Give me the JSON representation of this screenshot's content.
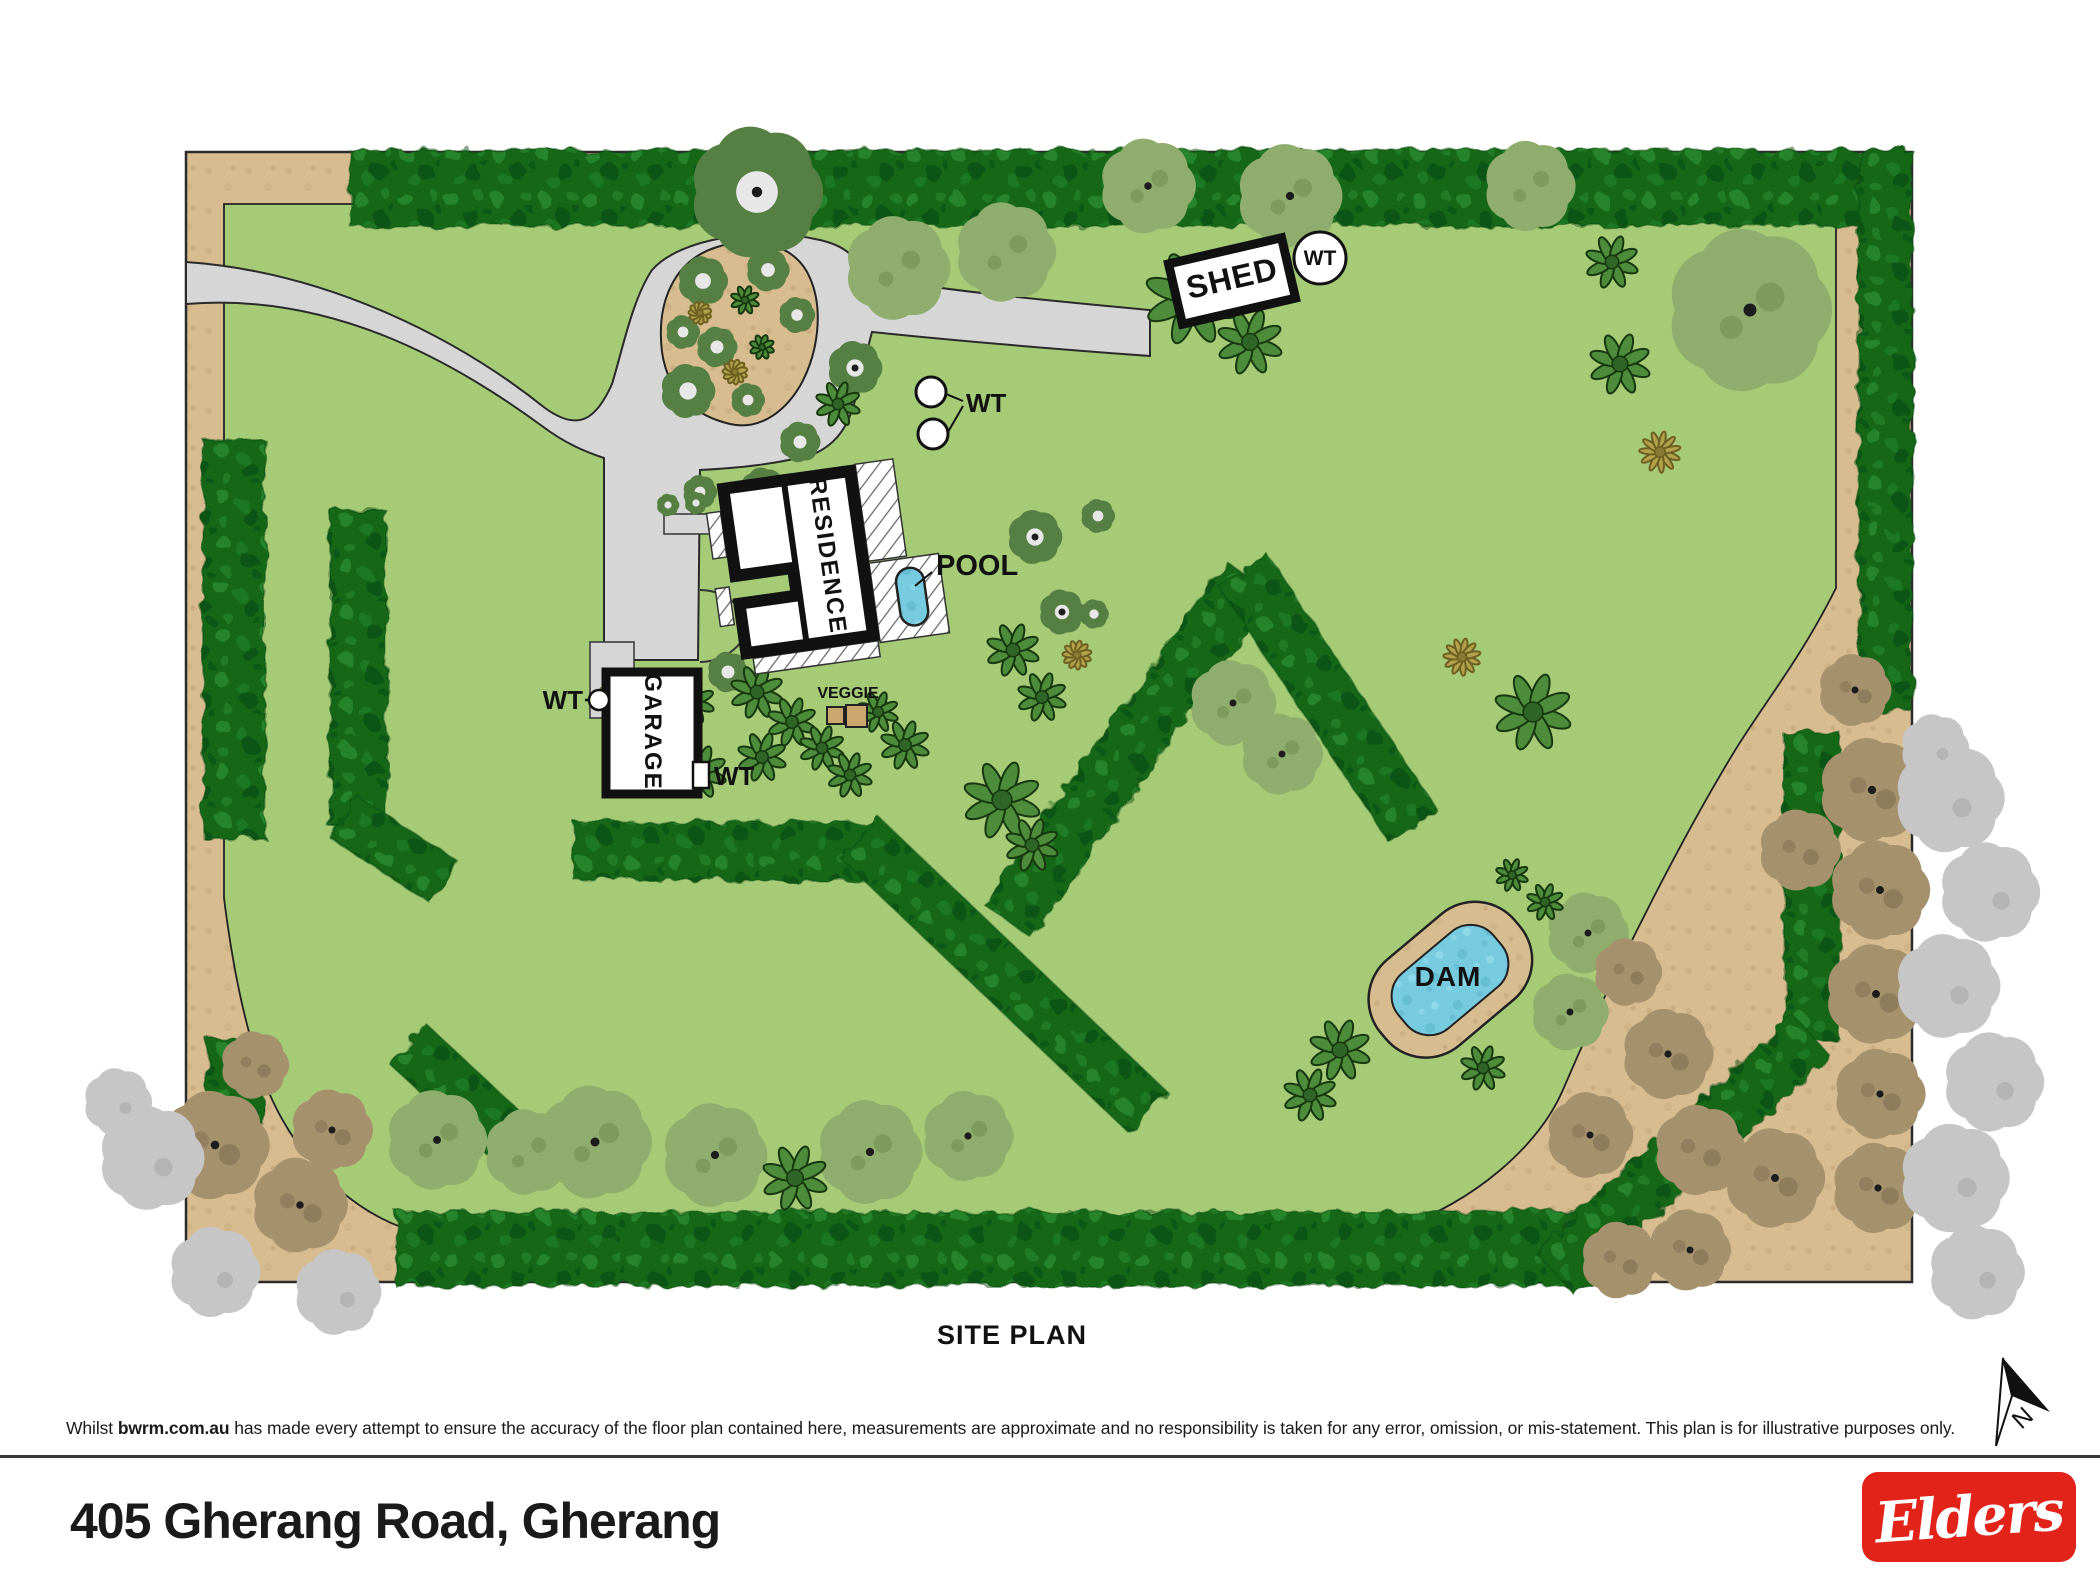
{
  "meta": {
    "address": "405 Gherang Road, Gherang",
    "plan_title": "SITE PLAN"
  },
  "labels": {
    "shed": "SHED",
    "residence": "RESIDENCE",
    "garage": "GARAGE",
    "pool": "POOL",
    "veggie": "VEGGIE",
    "dam": "DAM",
    "wt": "WT",
    "north": "N"
  },
  "disclaimer": {
    "prefix": "Whilst ",
    "brand": "bwrm.com.au",
    "suffix": " has made every attempt to ensure the accuracy of the floor plan contained here, measurements are approximate and no responsibility is taken for any error, omission, or mis-statement. This plan is for illustrative purposes only."
  },
  "logo": {
    "text": "Elders",
    "color": "#e2231a"
  },
  "colors": {
    "grass": "#a5cb76",
    "border_tan": "#d7bc90",
    "hedge": "#156818",
    "hedge_light": "#2e9032",
    "road": "#d6d6d6",
    "water": "#76cbdf",
    "building": "#111111",
    "olive_tree": "#8fae6d",
    "dark_tree": "#567f43",
    "star_bush": "#4d8c3a",
    "yellow_bush": "#b3a14c",
    "scrub_tree": "#a6916d",
    "gray_tree": "#c6c6c6",
    "logo_red": "#e2231a"
  },
  "plan": {
    "hedges": [
      {
        "x": 350,
        "y": 188,
        "len": 1560,
        "w": 76,
        "a": 0
      },
      {
        "x": 1885,
        "y": 150,
        "len": 560,
        "w": 54,
        "a": 90
      },
      {
        "x": 396,
        "y": 1249,
        "len": 1244,
        "w": 74,
        "a": 0
      },
      {
        "x": 234,
        "y": 440,
        "len": 398,
        "w": 62,
        "a": 90
      },
      {
        "x": 236,
        "y": 1040,
        "len": 86,
        "w": 58,
        "a": 90
      },
      {
        "x": 358,
        "y": 510,
        "len": 318,
        "w": 56,
        "a": 90
      },
      {
        "x": 345,
        "y": 818,
        "len": 118,
        "w": 50,
        "a": 33
      },
      {
        "x": 408,
        "y": 1044,
        "len": 160,
        "w": 54,
        "a": 43
      },
      {
        "x": 574,
        "y": 851,
        "len": 304,
        "w": 58,
        "a": 0
      },
      {
        "x": 860,
        "y": 838,
        "len": 398,
        "w": 56,
        "a": 43.6
      },
      {
        "x": 1250,
        "y": 578,
        "len": 420,
        "w": 58,
        "a": 125.3
      },
      {
        "x": 1243,
        "y": 570,
        "len": 308,
        "w": 58,
        "a": 56.4
      },
      {
        "x": 1812,
        "y": 733,
        "len": 306,
        "w": 56,
        "a": 90
      },
      {
        "x": 1812,
        "y": 1036,
        "len": 350,
        "w": 56,
        "a": 137.6
      }
    ],
    "trees": [
      {
        "t": "o",
        "x": 898,
        "y": 268,
        "r": 46
      },
      {
        "t": "o",
        "x": 1006,
        "y": 252,
        "r": 44
      },
      {
        "t": "o",
        "x": 1148,
        "y": 186,
        "r": 42,
        "d": 1
      },
      {
        "t": "o",
        "x": 1290,
        "y": 196,
        "r": 46,
        "d": 1
      },
      {
        "t": "o",
        "x": 1530,
        "y": 186,
        "r": 40
      },
      {
        "t": "o",
        "x": 1750,
        "y": 310,
        "r": 72,
        "d": 1
      },
      {
        "t": "o",
        "x": 1233,
        "y": 703,
        "r": 38,
        "d": 1
      },
      {
        "t": "o",
        "x": 1282,
        "y": 754,
        "r": 36,
        "d": 1
      },
      {
        "t": "o",
        "x": 1588,
        "y": 933,
        "r": 36,
        "d": 1
      },
      {
        "t": "o",
        "x": 1570,
        "y": 1012,
        "r": 34,
        "d": 1
      },
      {
        "t": "o",
        "x": 595,
        "y": 1142,
        "r": 50,
        "d": 1
      },
      {
        "t": "o",
        "x": 715,
        "y": 1155,
        "r": 46,
        "d": 1
      },
      {
        "t": "o",
        "x": 870,
        "y": 1152,
        "r": 46,
        "d": 1
      },
      {
        "t": "o",
        "x": 968,
        "y": 1136,
        "r": 40,
        "d": 1
      },
      {
        "t": "o",
        "x": 437,
        "y": 1140,
        "r": 44,
        "d": 1
      },
      {
        "t": "o",
        "x": 528,
        "y": 1152,
        "r": 38
      },
      {
        "t": "w",
        "x": 757,
        "y": 192,
        "r": 58,
        "d": 1
      },
      {
        "t": "w",
        "x": 1035,
        "y": 537,
        "r": 24,
        "d": 1
      },
      {
        "t": "w",
        "x": 1098,
        "y": 516,
        "r": 15
      },
      {
        "t": "w",
        "x": 1062,
        "y": 612,
        "r": 20,
        "d": 1
      },
      {
        "t": "w",
        "x": 1094,
        "y": 614,
        "r": 13
      },
      {
        "t": "w",
        "x": 703,
        "y": 281,
        "r": 22
      },
      {
        "t": "w",
        "x": 768,
        "y": 270,
        "r": 19
      },
      {
        "t": "w",
        "x": 797,
        "y": 315,
        "r": 16
      },
      {
        "t": "w",
        "x": 683,
        "y": 332,
        "r": 15
      },
      {
        "t": "w",
        "x": 717,
        "y": 347,
        "r": 18
      },
      {
        "t": "w",
        "x": 688,
        "y": 391,
        "r": 24
      },
      {
        "t": "w",
        "x": 748,
        "y": 400,
        "r": 15
      },
      {
        "t": "w",
        "x": 855,
        "y": 368,
        "r": 24,
        "d": 1
      },
      {
        "t": "w",
        "x": 800,
        "y": 442,
        "r": 18
      },
      {
        "t": "w",
        "x": 763,
        "y": 490,
        "r": 20
      },
      {
        "t": "w",
        "x": 700,
        "y": 492,
        "r": 15
      },
      {
        "t": "w",
        "x": 728,
        "y": 672,
        "r": 18
      },
      {
        "t": "w",
        "x": 615,
        "y": 698,
        "r": 16
      },
      {
        "t": "w",
        "x": 655,
        "y": 737,
        "r": 13
      },
      {
        "t": "w",
        "x": 668,
        "y": 505,
        "r": 10
      },
      {
        "t": "w",
        "x": 696,
        "y": 503,
        "r": 10
      },
      {
        "t": "s",
        "x": 838,
        "y": 404,
        "r": 22
      },
      {
        "t": "s",
        "x": 1192,
        "y": 298,
        "r": 46
      },
      {
        "t": "s",
        "x": 1250,
        "y": 342,
        "r": 32
      },
      {
        "t": "s",
        "x": 1013,
        "y": 650,
        "r": 26
      },
      {
        "t": "s",
        "x": 1042,
        "y": 697,
        "r": 24
      },
      {
        "t": "s",
        "x": 1533,
        "y": 712,
        "r": 38
      },
      {
        "t": "s",
        "x": 1612,
        "y": 262,
        "r": 26
      },
      {
        "t": "s",
        "x": 1620,
        "y": 364,
        "r": 30
      },
      {
        "t": "s",
        "x": 745,
        "y": 300,
        "r": 14
      },
      {
        "t": "s",
        "x": 762,
        "y": 347,
        "r": 12
      },
      {
        "t": "s",
        "x": 1340,
        "y": 1050,
        "r": 30
      },
      {
        "t": "s",
        "x": 1310,
        "y": 1095,
        "r": 26
      },
      {
        "t": "s",
        "x": 1483,
        "y": 1068,
        "r": 22
      },
      {
        "t": "s",
        "x": 1512,
        "y": 875,
        "r": 16
      },
      {
        "t": "s",
        "x": 1545,
        "y": 902,
        "r": 18
      },
      {
        "t": "s",
        "x": 1002,
        "y": 800,
        "r": 38
      },
      {
        "t": "s",
        "x": 1032,
        "y": 845,
        "r": 26
      },
      {
        "t": "s",
        "x": 757,
        "y": 692,
        "r": 26
      },
      {
        "t": "s",
        "x": 792,
        "y": 722,
        "r": 24
      },
      {
        "t": "s",
        "x": 822,
        "y": 748,
        "r": 22
      },
      {
        "t": "s",
        "x": 762,
        "y": 757,
        "r": 24
      },
      {
        "t": "s",
        "x": 700,
        "y": 772,
        "r": 26
      },
      {
        "t": "s",
        "x": 657,
        "y": 742,
        "r": 20
      },
      {
        "t": "s",
        "x": 692,
        "y": 702,
        "r": 22
      },
      {
        "t": "s",
        "x": 905,
        "y": 745,
        "r": 24
      },
      {
        "t": "s",
        "x": 878,
        "y": 712,
        "r": 20
      },
      {
        "t": "s",
        "x": 850,
        "y": 775,
        "r": 22
      },
      {
        "t": "s",
        "x": 795,
        "y": 1178,
        "r": 32
      },
      {
        "t": "y",
        "x": 735,
        "y": 372,
        "r": 12
      },
      {
        "t": "y",
        "x": 700,
        "y": 313,
        "r": 11
      },
      {
        "t": "y",
        "x": 1462,
        "y": 657,
        "r": 18
      },
      {
        "t": "y",
        "x": 1077,
        "y": 655,
        "r": 14
      },
      {
        "t": "y",
        "x": 1660,
        "y": 452,
        "r": 20
      },
      {
        "t": "b",
        "x": 215,
        "y": 1145,
        "r": 48,
        "d": 1
      },
      {
        "t": "b",
        "x": 300,
        "y": 1205,
        "r": 42,
        "d": 1
      },
      {
        "t": "b",
        "x": 332,
        "y": 1130,
        "r": 36,
        "d": 1
      },
      {
        "t": "b",
        "x": 255,
        "y": 1065,
        "r": 30
      },
      {
        "t": "b",
        "x": 1872,
        "y": 790,
        "r": 46,
        "d": 1
      },
      {
        "t": "b",
        "x": 1880,
        "y": 890,
        "r": 44,
        "d": 1
      },
      {
        "t": "b",
        "x": 1876,
        "y": 994,
        "r": 44,
        "d": 1
      },
      {
        "t": "b",
        "x": 1668,
        "y": 1054,
        "r": 40,
        "d": 1
      },
      {
        "t": "b",
        "x": 1590,
        "y": 1135,
        "r": 38,
        "d": 1
      },
      {
        "t": "b",
        "x": 1880,
        "y": 1094,
        "r": 40,
        "d": 1
      },
      {
        "t": "b",
        "x": 1775,
        "y": 1178,
        "r": 44,
        "d": 1
      },
      {
        "t": "b",
        "x": 1878,
        "y": 1188,
        "r": 40,
        "d": 1
      },
      {
        "t": "b",
        "x": 1690,
        "y": 1250,
        "r": 36,
        "d": 1
      },
      {
        "t": "b",
        "x": 1628,
        "y": 972,
        "r": 30
      },
      {
        "t": "b",
        "x": 1855,
        "y": 690,
        "r": 32,
        "d": 1
      },
      {
        "t": "b",
        "x": 1800,
        "y": 850,
        "r": 36
      },
      {
        "t": "b",
        "x": 1700,
        "y": 1150,
        "r": 40
      },
      {
        "t": "b",
        "x": 1620,
        "y": 1260,
        "r": 34
      },
      {
        "t": "g",
        "x": 152,
        "y": 1158,
        "r": 46
      },
      {
        "t": "g",
        "x": 215,
        "y": 1272,
        "r": 40
      },
      {
        "t": "g",
        "x": 338,
        "y": 1292,
        "r": 38
      },
      {
        "t": "g",
        "x": 118,
        "y": 1102,
        "r": 30
      },
      {
        "t": "g",
        "x": 1950,
        "y": 798,
        "r": 48
      },
      {
        "t": "g",
        "x": 1990,
        "y": 892,
        "r": 44
      },
      {
        "t": "g",
        "x": 1948,
        "y": 986,
        "r": 46
      },
      {
        "t": "g",
        "x": 1994,
        "y": 1082,
        "r": 44
      },
      {
        "t": "g",
        "x": 1955,
        "y": 1178,
        "r": 48
      },
      {
        "t": "g",
        "x": 1977,
        "y": 1272,
        "r": 42
      },
      {
        "t": "g",
        "x": 1935,
        "y": 748,
        "r": 30
      }
    ]
  }
}
